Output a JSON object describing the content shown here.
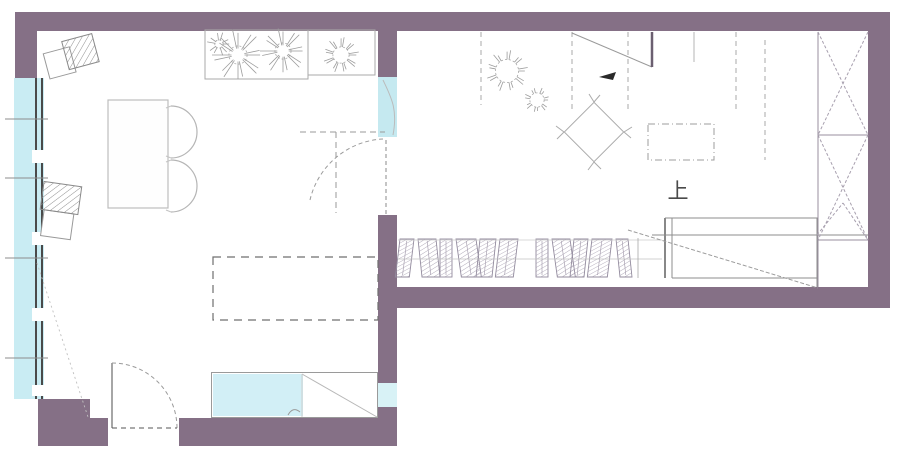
{
  "plan": {
    "type": "apartment-floor-plan",
    "labels": {
      "up": "上"
    },
    "colors": {
      "wall": "#857086",
      "window_glass": "#c9ecf3",
      "counter_glass": "#d2eff6",
      "line": "#999999",
      "dash_line": "#777777",
      "label_text": "#4a4a4a"
    },
    "symbols": [
      "hatched-armchair",
      "dining-table-with-round-chairs",
      "planter-with-flowers",
      "potted-plants",
      "overhead-cabinet-dashed",
      "hanging-clothes-rail",
      "staircase-up",
      "tall-cabinet-x-doors",
      "entry-door-swing",
      "interior-glass-door",
      "sink-counter",
      "ceiling-fixture-diamond",
      "direction-arrow"
    ]
  }
}
